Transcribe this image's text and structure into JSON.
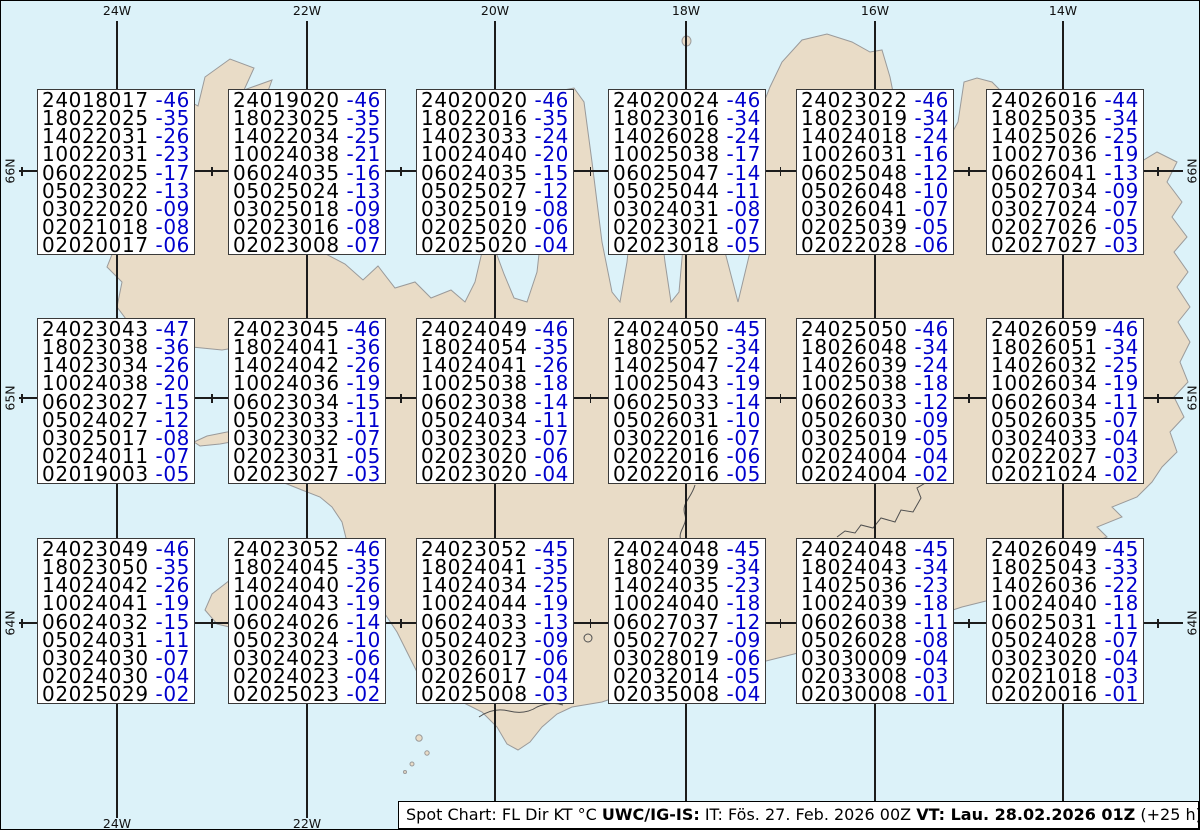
{
  "colors": {
    "ocean": "#dcf2f9",
    "land": "#e9dcc7",
    "coast": "#9a9a9a",
    "detail": "#4f4f4f",
    "grid": "#1c1c1c",
    "frame": "#000000",
    "boxbg": "#ffffff",
    "boxborder": "#3a3a3a",
    "text": "#000000",
    "temp": "#0000cd"
  },
  "axis": {
    "meridians": [
      {
        "label": "24W",
        "x": 116
      },
      {
        "label": "22W",
        "x": 306
      },
      {
        "label": "20W",
        "x": 494
      },
      {
        "label": "18W",
        "x": 685
      },
      {
        "label": "16W",
        "x": 874
      },
      {
        "label": "14W",
        "x": 1062
      }
    ],
    "parallels": [
      {
        "label": "66N",
        "y": 170
      },
      {
        "label": "65N",
        "y": 397
      },
      {
        "label": "64N",
        "y": 622
      }
    ]
  },
  "boxes": [
    {
      "lines": [
        [
          "240180",
          "17",
          "-46"
        ],
        [
          "180220",
          "25",
          "-35"
        ],
        [
          "140220",
          "31",
          "-26"
        ],
        [
          "100220",
          "31",
          "-23"
        ],
        [
          "060220",
          "25",
          "-17"
        ],
        [
          "050230",
          "22",
          "-13"
        ],
        [
          "030220",
          "20",
          "-09"
        ],
        [
          "020210",
          "18",
          "-08"
        ],
        [
          "020200",
          "17",
          "-06"
        ]
      ]
    },
    {
      "lines": [
        [
          "240190",
          "20",
          "-46"
        ],
        [
          "180230",
          "25",
          "-35"
        ],
        [
          "140220",
          "34",
          "-25"
        ],
        [
          "100240",
          "38",
          "-21"
        ],
        [
          "060240",
          "35",
          "-16"
        ],
        [
          "050250",
          "24",
          "-13"
        ],
        [
          "030250",
          "18",
          "-09"
        ],
        [
          "020230",
          "16",
          "-08"
        ],
        [
          "020230",
          "08",
          "-07"
        ]
      ]
    },
    {
      "lines": [
        [
          "240200",
          "20",
          "-46"
        ],
        [
          "180220",
          "16",
          "-35"
        ],
        [
          "140230",
          "33",
          "-24"
        ],
        [
          "100240",
          "40",
          "-20"
        ],
        [
          "060240",
          "35",
          "-15"
        ],
        [
          "050250",
          "27",
          "-12"
        ],
        [
          "030250",
          "19",
          "-08"
        ],
        [
          "020250",
          "20",
          "-06"
        ],
        [
          "020250",
          "20",
          "-04"
        ]
      ]
    },
    {
      "lines": [
        [
          "240200",
          "24",
          "-46"
        ],
        [
          "180230",
          "16",
          "-34"
        ],
        [
          "140260",
          "28",
          "-24"
        ],
        [
          "100250",
          "38",
          "-17"
        ],
        [
          "060250",
          "47",
          "-14"
        ],
        [
          "050250",
          "44",
          "-11"
        ],
        [
          "030240",
          "31",
          "-08"
        ],
        [
          "020230",
          "21",
          "-07"
        ],
        [
          "020230",
          "18",
          "-05"
        ]
      ]
    },
    {
      "lines": [
        [
          "240230",
          "22",
          "-46"
        ],
        [
          "180230",
          "19",
          "-34"
        ],
        [
          "140240",
          "18",
          "-24"
        ],
        [
          "100260",
          "31",
          "-16"
        ],
        [
          "060250",
          "48",
          "-12"
        ],
        [
          "050260",
          "48",
          "-10"
        ],
        [
          "030260",
          "41",
          "-07"
        ],
        [
          "020250",
          "39",
          "-05"
        ],
        [
          "020220",
          "28",
          "-06"
        ]
      ]
    },
    {
      "lines": [
        [
          "240260",
          "16",
          "-44"
        ],
        [
          "180250",
          "35",
          "-34"
        ],
        [
          "140250",
          "26",
          "-25"
        ],
        [
          "100270",
          "36",
          "-19"
        ],
        [
          "060260",
          "41",
          "-13"
        ],
        [
          "050270",
          "34",
          "-09"
        ],
        [
          "030270",
          "24",
          "-07"
        ],
        [
          "020270",
          "26",
          "-05"
        ],
        [
          "020270",
          "27",
          "-03"
        ]
      ]
    },
    {
      "lines": [
        [
          "240230",
          "43",
          "-47"
        ],
        [
          "180230",
          "38",
          "-36"
        ],
        [
          "140230",
          "34",
          "-26"
        ],
        [
          "100240",
          "38",
          "-20"
        ],
        [
          "060230",
          "27",
          "-15"
        ],
        [
          "050240",
          "27",
          "-12"
        ],
        [
          "030250",
          "17",
          "-08"
        ],
        [
          "020240",
          "11",
          "-07"
        ],
        [
          "020190",
          "03",
          "-05"
        ]
      ]
    },
    {
      "lines": [
        [
          "240230",
          "45",
          "-46"
        ],
        [
          "180240",
          "41",
          "-36"
        ],
        [
          "140240",
          "42",
          "-26"
        ],
        [
          "100240",
          "36",
          "-19"
        ],
        [
          "060230",
          "34",
          "-15"
        ],
        [
          "050230",
          "33",
          "-11"
        ],
        [
          "030230",
          "32",
          "-07"
        ],
        [
          "020230",
          "31",
          "-05"
        ],
        [
          "020230",
          "27",
          "-03"
        ]
      ]
    },
    {
      "lines": [
        [
          "240240",
          "49",
          "-46"
        ],
        [
          "180240",
          "54",
          "-35"
        ],
        [
          "140240",
          "41",
          "-26"
        ],
        [
          "100250",
          "38",
          "-18"
        ],
        [
          "060230",
          "38",
          "-14"
        ],
        [
          "050240",
          "34",
          "-11"
        ],
        [
          "030230",
          "23",
          "-07"
        ],
        [
          "020230",
          "20",
          "-06"
        ],
        [
          "020230",
          "20",
          "-04"
        ]
      ]
    },
    {
      "lines": [
        [
          "240240",
          "50",
          "-45"
        ],
        [
          "180250",
          "52",
          "-34"
        ],
        [
          "140250",
          "47",
          "-24"
        ],
        [
          "100250",
          "43",
          "-19"
        ],
        [
          "060250",
          "33",
          "-14"
        ],
        [
          "050260",
          "31",
          "-10"
        ],
        [
          "030220",
          "16",
          "-07"
        ],
        [
          "020220",
          "16",
          "-06"
        ],
        [
          "020220",
          "16",
          "-05"
        ]
      ]
    },
    {
      "lines": [
        [
          "240250",
          "50",
          "-46"
        ],
        [
          "180260",
          "48",
          "-34"
        ],
        [
          "140260",
          "39",
          "-24"
        ],
        [
          "100250",
          "38",
          "-18"
        ],
        [
          "060260",
          "33",
          "-12"
        ],
        [
          "050260",
          "30",
          "-09"
        ],
        [
          "030250",
          "19",
          "-05"
        ],
        [
          "020240",
          "04",
          "-04"
        ],
        [
          "020240",
          "04",
          "-02"
        ]
      ]
    },
    {
      "lines": [
        [
          "240260",
          "59",
          "-46"
        ],
        [
          "180260",
          "51",
          "-34"
        ],
        [
          "140260",
          "32",
          "-25"
        ],
        [
          "100260",
          "34",
          "-19"
        ],
        [
          "060260",
          "34",
          "-11"
        ],
        [
          "050260",
          "35",
          "-07"
        ],
        [
          "030240",
          "33",
          "-04"
        ],
        [
          "020220",
          "27",
          "-03"
        ],
        [
          "020210",
          "24",
          "-02"
        ]
      ]
    },
    {
      "lines": [
        [
          "240230",
          "49",
          "-46"
        ],
        [
          "180230",
          "50",
          "-35"
        ],
        [
          "140240",
          "42",
          "-26"
        ],
        [
          "100240",
          "41",
          "-19"
        ],
        [
          "060240",
          "32",
          "-15"
        ],
        [
          "050240",
          "31",
          "-11"
        ],
        [
          "030240",
          "30",
          "-07"
        ],
        [
          "020240",
          "30",
          "-04"
        ],
        [
          "020250",
          "29",
          "-02"
        ]
      ]
    },
    {
      "lines": [
        [
          "240230",
          "52",
          "-46"
        ],
        [
          "180240",
          "45",
          "-35"
        ],
        [
          "140240",
          "40",
          "-26"
        ],
        [
          "100240",
          "43",
          "-19"
        ],
        [
          "060240",
          "26",
          "-14"
        ],
        [
          "050230",
          "24",
          "-10"
        ],
        [
          "030240",
          "23",
          "-06"
        ],
        [
          "020240",
          "23",
          "-04"
        ],
        [
          "020250",
          "23",
          "-02"
        ]
      ]
    },
    {
      "lines": [
        [
          "240230",
          "52",
          "-45"
        ],
        [
          "180240",
          "41",
          "-35"
        ],
        [
          "140240",
          "34",
          "-25"
        ],
        [
          "100240",
          "44",
          "-19"
        ],
        [
          "060240",
          "33",
          "-13"
        ],
        [
          "050240",
          "23",
          "-09"
        ],
        [
          "030260",
          "17",
          "-06"
        ],
        [
          "020260",
          "17",
          "-04"
        ],
        [
          "020250",
          "08",
          "-03"
        ]
      ]
    },
    {
      "lines": [
        [
          "240240",
          "48",
          "-45"
        ],
        [
          "180240",
          "39",
          "-34"
        ],
        [
          "140240",
          "35",
          "-23"
        ],
        [
          "100240",
          "40",
          "-18"
        ],
        [
          "060270",
          "37",
          "-12"
        ],
        [
          "050270",
          "27",
          "-09"
        ],
        [
          "030280",
          "19",
          "-06"
        ],
        [
          "020320",
          "14",
          "-05"
        ],
        [
          "020350",
          "08",
          "-04"
        ]
      ]
    },
    {
      "lines": [
        [
          "240240",
          "48",
          "-45"
        ],
        [
          "180240",
          "43",
          "-34"
        ],
        [
          "140250",
          "36",
          "-23"
        ],
        [
          "100240",
          "39",
          "-18"
        ],
        [
          "060260",
          "38",
          "-11"
        ],
        [
          "050260",
          "28",
          "-08"
        ],
        [
          "030300",
          "09",
          "-04"
        ],
        [
          "020330",
          "08",
          "-03"
        ],
        [
          "020300",
          "08",
          "-01"
        ]
      ]
    },
    {
      "lines": [
        [
          "240260",
          "49",
          "-45"
        ],
        [
          "180250",
          "43",
          "-33"
        ],
        [
          "140260",
          "36",
          "-22"
        ],
        [
          "100240",
          "40",
          "-18"
        ],
        [
          "060250",
          "31",
          "-11"
        ],
        [
          "050240",
          "28",
          "-07"
        ],
        [
          "030230",
          "20",
          "-04"
        ],
        [
          "020210",
          "18",
          "-03"
        ],
        [
          "020200",
          "16",
          "-01"
        ]
      ]
    }
  ],
  "caption": {
    "segments": [
      {
        "text": "Spot Chart: FL Dir KT °C ",
        "bold": false
      },
      {
        "text": "UWC/IG-IS:",
        "bold": true
      },
      {
        "text": " IT: Fös. 27. Feb. 2026 00Z ",
        "bold": false
      },
      {
        "text": "VT: Lau. 28.02.2026 01Z",
        "bold": true
      },
      {
        "text": " (+25 h)",
        "bold": false
      }
    ]
  }
}
